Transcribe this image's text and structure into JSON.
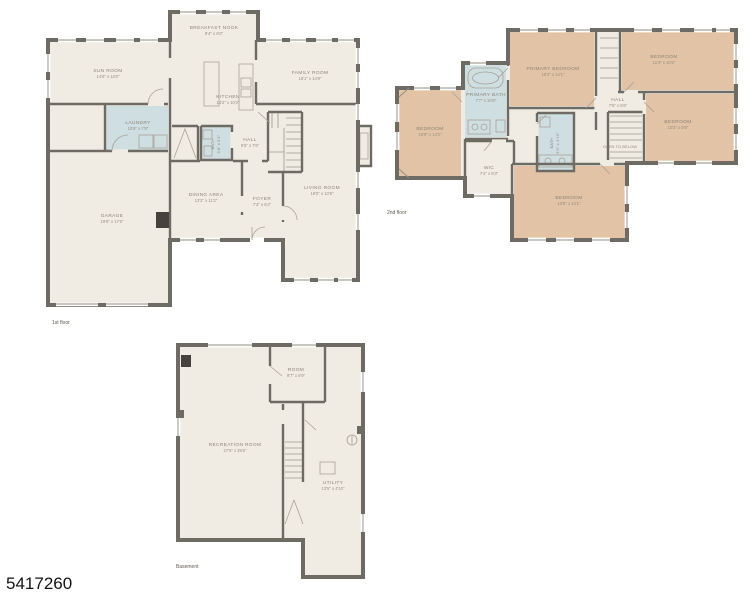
{
  "watermark": "5417260",
  "colors": {
    "walls": "#6e6a64",
    "floor_fill": "#f1ece3",
    "bedroom_fill": "#e2c3a5",
    "bath_fill": "#cfdfe1",
    "background": "#ffffff"
  },
  "floors": {
    "first": {
      "label": "1st floor",
      "rooms": [
        {
          "name": "BREAKFAST NOOK",
          "dims": "9'4\" x 6'8\""
        },
        {
          "name": "SUN ROOM",
          "dims": "14'6\" x 13'0\""
        },
        {
          "name": "FAMILY ROOM",
          "dims": "18'1\" x 14'9\""
        },
        {
          "name": "KITCHEN",
          "dims": "14'2\" x 10'2\""
        },
        {
          "name": "LAUNDRY",
          "dims": "10'6\" x 7'8\""
        },
        {
          "name": "BATH",
          "dims": "6'8\" x 5'2\""
        },
        {
          "name": "HALL",
          "dims": "9'6\" x 7'6\""
        },
        {
          "name": "DINING AREA",
          "dims": "13'2\" x 11'2\""
        },
        {
          "name": "FOYER",
          "dims": "7'2\" x 6'2\""
        },
        {
          "name": "LIVING ROOM",
          "dims": "19'5\" x 13'9\""
        },
        {
          "name": "GARAGE",
          "dims": "19'8\" x 17'6\""
        }
      ]
    },
    "second": {
      "label": "2nd floor",
      "rooms": [
        {
          "name": "PRIMARY BEDROOM",
          "dims": "16'4\" x 14'1\""
        },
        {
          "name": "PRIMARY BATH",
          "dims": "7'7\" x 10'6\""
        },
        {
          "name": "BEDROOM",
          "dims": "15'6\" x 14'2\""
        },
        {
          "name": "BEDROOM",
          "dims": "11'4\" x 10'6\""
        },
        {
          "name": "BEDROOM",
          "dims": "10'2\" x 9'8\""
        },
        {
          "name": "BEDROOM",
          "dims": "13'8\" x 13'1\""
        },
        {
          "name": "HALL",
          "dims": "7'6\" x 6'6\""
        },
        {
          "name": "WIC",
          "dims": "7'4\" x 6'3\""
        },
        {
          "name": "BATH",
          "dims": "8'0\" x 4'10\""
        },
        {
          "name": "OPEN TO BELOW",
          "dims": ""
        }
      ]
    },
    "basement": {
      "label": "Basement",
      "rooms": [
        {
          "name": "RECREATION ROOM",
          "dims": "27'5\" x 25'5\""
        },
        {
          "name": "ROOM",
          "dims": "9'7\" x 8'9\""
        },
        {
          "name": "UTILITY",
          "dims": "13'5\" x 4'10\""
        }
      ]
    }
  }
}
